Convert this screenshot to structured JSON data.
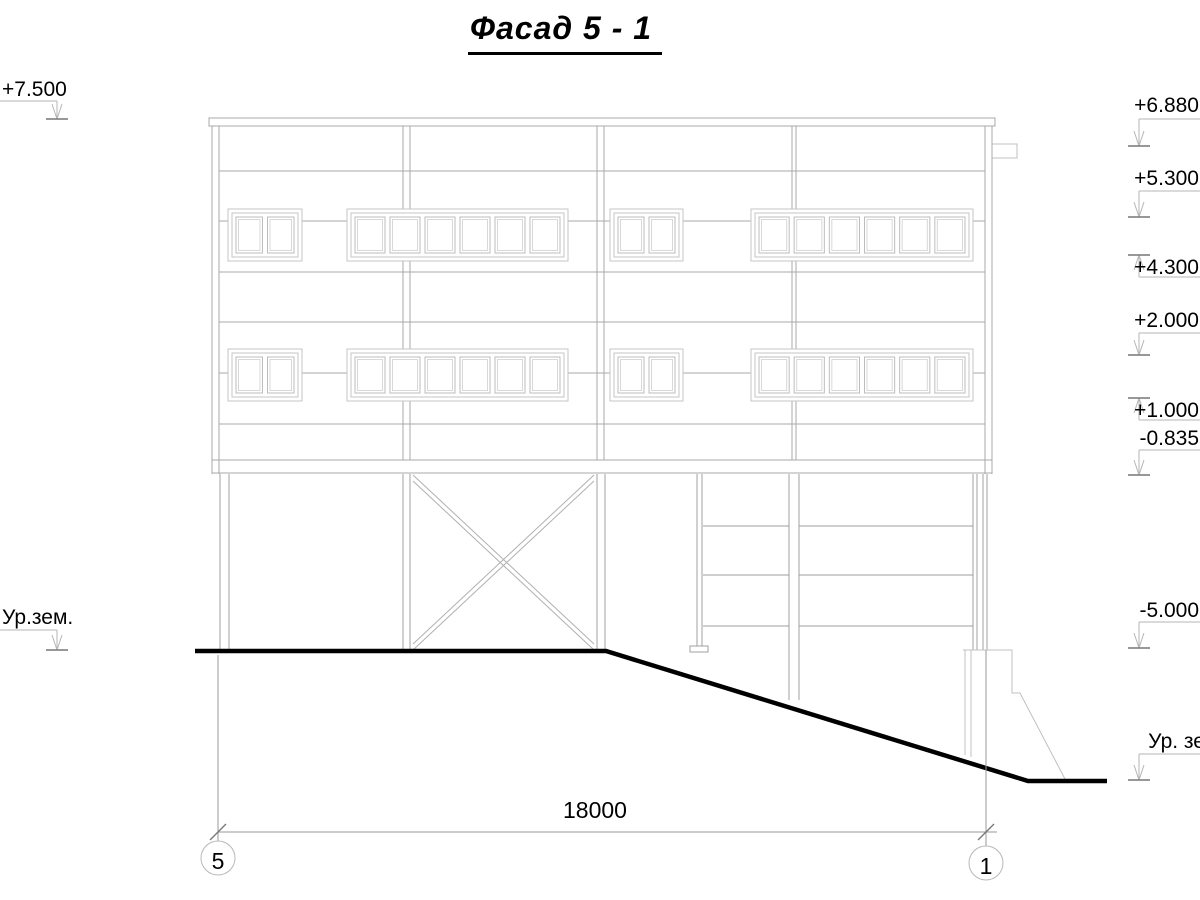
{
  "title": "Фасад 5 - 1",
  "elevations": {
    "left": [
      {
        "label": "+7.500"
      },
      {
        "label": "Ур.зем."
      }
    ],
    "right": [
      {
        "label": "+6.880"
      },
      {
        "label": "+5.300"
      },
      {
        "label": "+4.300"
      },
      {
        "label": "+2.000"
      },
      {
        "label": "+1.000"
      },
      {
        "label": "-0.835"
      },
      {
        "label": "-5.000"
      },
      {
        "label": "Ур. зе"
      }
    ]
  },
  "dimension": {
    "total_length": "18000"
  },
  "axes": {
    "start": "5",
    "end": "1"
  },
  "colors": {
    "line": "#a8a8a8",
    "light_line": "#c6c6c6",
    "ground_line": "#000000"
  }
}
